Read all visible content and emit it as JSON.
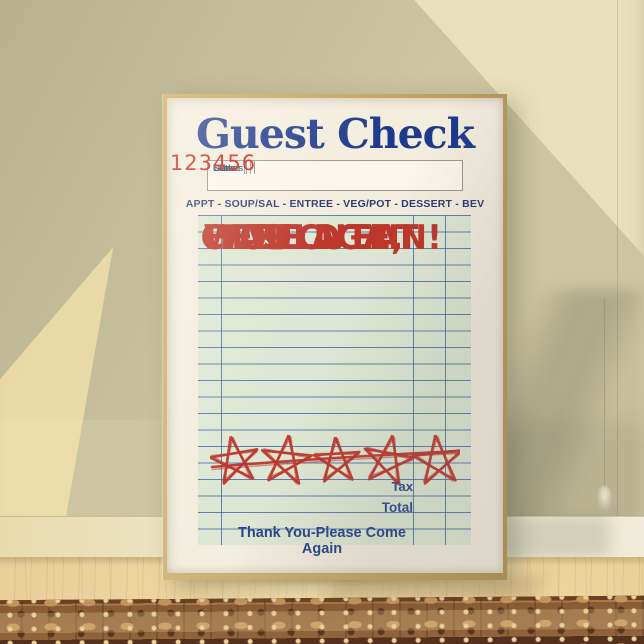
{
  "poster": {
    "title": "Guest Check",
    "header_table": {
      "columns": [
        "Date",
        "Table",
        "Guests",
        "Server"
      ],
      "check_number": "123456"
    },
    "menu_line": "APPT - SOUP/SAL - ENTREE - VEG/POT - DESSERT - BEV",
    "message_lines": [
      "CHEF",
      "WAS CUTE,",
      "WOULD EAT",
      "HERE AGAIN!"
    ],
    "rating": {
      "stars": 5,
      "style": "crossed-pentagram-doodle"
    },
    "totals": {
      "tax_label": "Tax",
      "total_label": "Total"
    },
    "footer": "Thank You-Please Come Again",
    "colors": {
      "title_blue": "#1d398c",
      "text_blue": "#2a4a92",
      "accent_red": "#bd362b",
      "number_red": "#c8231a",
      "receipt_mint": "#dee7d4",
      "grid_blue": "#3e62a5",
      "paper": "#f3edde",
      "frame_gold": "#c2a467"
    }
  },
  "scene": {
    "wall_color": "#ccc5a2",
    "baseboard_color": "#efe7cd",
    "floor_color": "#ead29b",
    "rug_color": "#8a5930"
  }
}
